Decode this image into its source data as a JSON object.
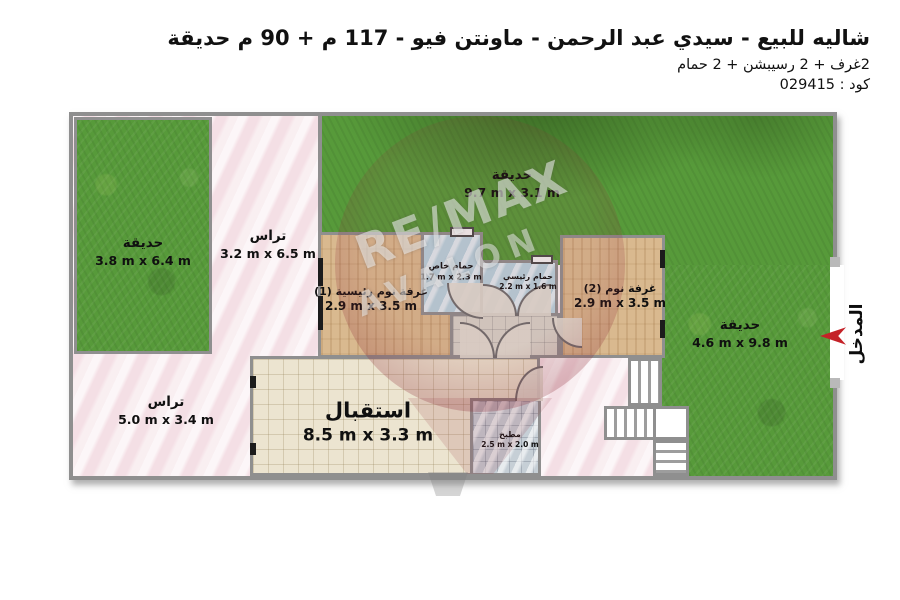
{
  "header": {
    "title": "شاليه للبيع - سيدي عبد الرحمن - ماونتن فيو - 117 م + 90 م حديقة",
    "subtitle": "2غرف + 2 رسيبشن + 2 حمام",
    "code_label": "كود : 029415"
  },
  "watermark": {
    "brand": "RE/MAX",
    "agency": "AVALON"
  },
  "entrance": {
    "label": "المدخل"
  },
  "colors": {
    "wall": "#8f8f8f",
    "grass": "#579a3a",
    "terrace_pink": "#f6e6ea",
    "wood": "#d9b98f",
    "bath_blue": "#b7d2dd",
    "reception_tile": "#ece4d0",
    "kitchen_tile": "#c6cfd6",
    "arrow_red": "#c42127"
  },
  "rooms": [
    {
      "id": "garden-left",
      "name": "حديقة",
      "dims": "3.8 m x 6.4 m"
    },
    {
      "id": "garden-top",
      "name": "حديقة",
      "dims": "9.7 m x 3.1 m"
    },
    {
      "id": "garden-right",
      "name": "حديقة",
      "dims": "4.6 m x 9.8 m"
    },
    {
      "id": "terrace-top",
      "name": "تراس",
      "dims": "3.2 m x 6.5 m"
    },
    {
      "id": "terrace-bottom",
      "name": "تراس",
      "dims": "5.0 m x 3.4 m"
    },
    {
      "id": "master-bedroom",
      "name": "غرفة نوم رئيسية (1)",
      "dims": "2.9 m x 3.5 m"
    },
    {
      "id": "bedroom-2",
      "name": "غرفة نوم (2)",
      "dims": "2.9 m x 3.5 m"
    },
    {
      "id": "private-bathroom",
      "name": "حمام خاص",
      "dims": "1.7 m x 2.3 m"
    },
    {
      "id": "main-bathroom",
      "name": "حمام رئيسي",
      "dims": "2.2 m x 1.6 m"
    },
    {
      "id": "reception",
      "name": "استقبال",
      "dims": "8.5 m x 3.3 m"
    },
    {
      "id": "kitchen",
      "name": "مطبخ",
      "dims": "2.5 m x 2.0 m"
    }
  ]
}
